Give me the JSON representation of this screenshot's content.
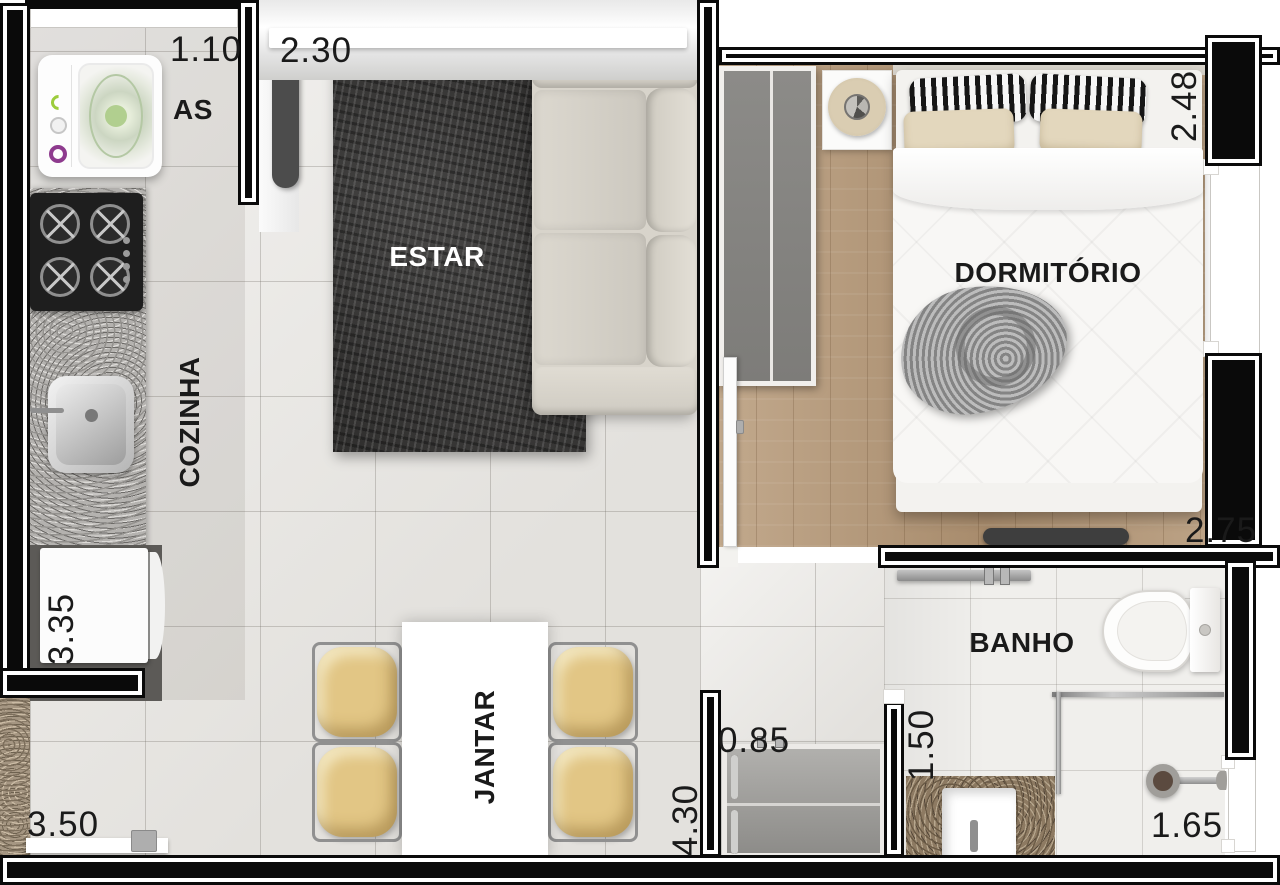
{
  "plan": {
    "rooms": {
      "as": "AS",
      "estar": "ESTAR",
      "cozinha": "COZINHA",
      "jantar": "JANTAR",
      "dormitorio": "DORMITÓRIO",
      "banho": "BANHO"
    },
    "measurements": {
      "as_width": "1.10",
      "estar_opening": "2.30",
      "dormitorio_width": "2.48",
      "cozinha_depth": "3.35",
      "dormitorio_depth": "2.75",
      "sala_width": "3.50",
      "sala_depth": "4.30",
      "closet_width": "0.85",
      "banho_width": "1.50",
      "banho_depth": "1.65"
    },
    "colors": {
      "wall": "#0a0a0a",
      "tile_floor": "#eae8e4",
      "wood_floor": "#b49879",
      "bath_floor": "#f0efec",
      "rug": "#302f2e",
      "sofa": "#d8d4cb",
      "chair": "#e2c685",
      "kitchen_granite": "#b4b2af",
      "bath_granite": "#8d7a62",
      "gravel": "#a59682",
      "label_text": "#1a1a1a"
    }
  }
}
